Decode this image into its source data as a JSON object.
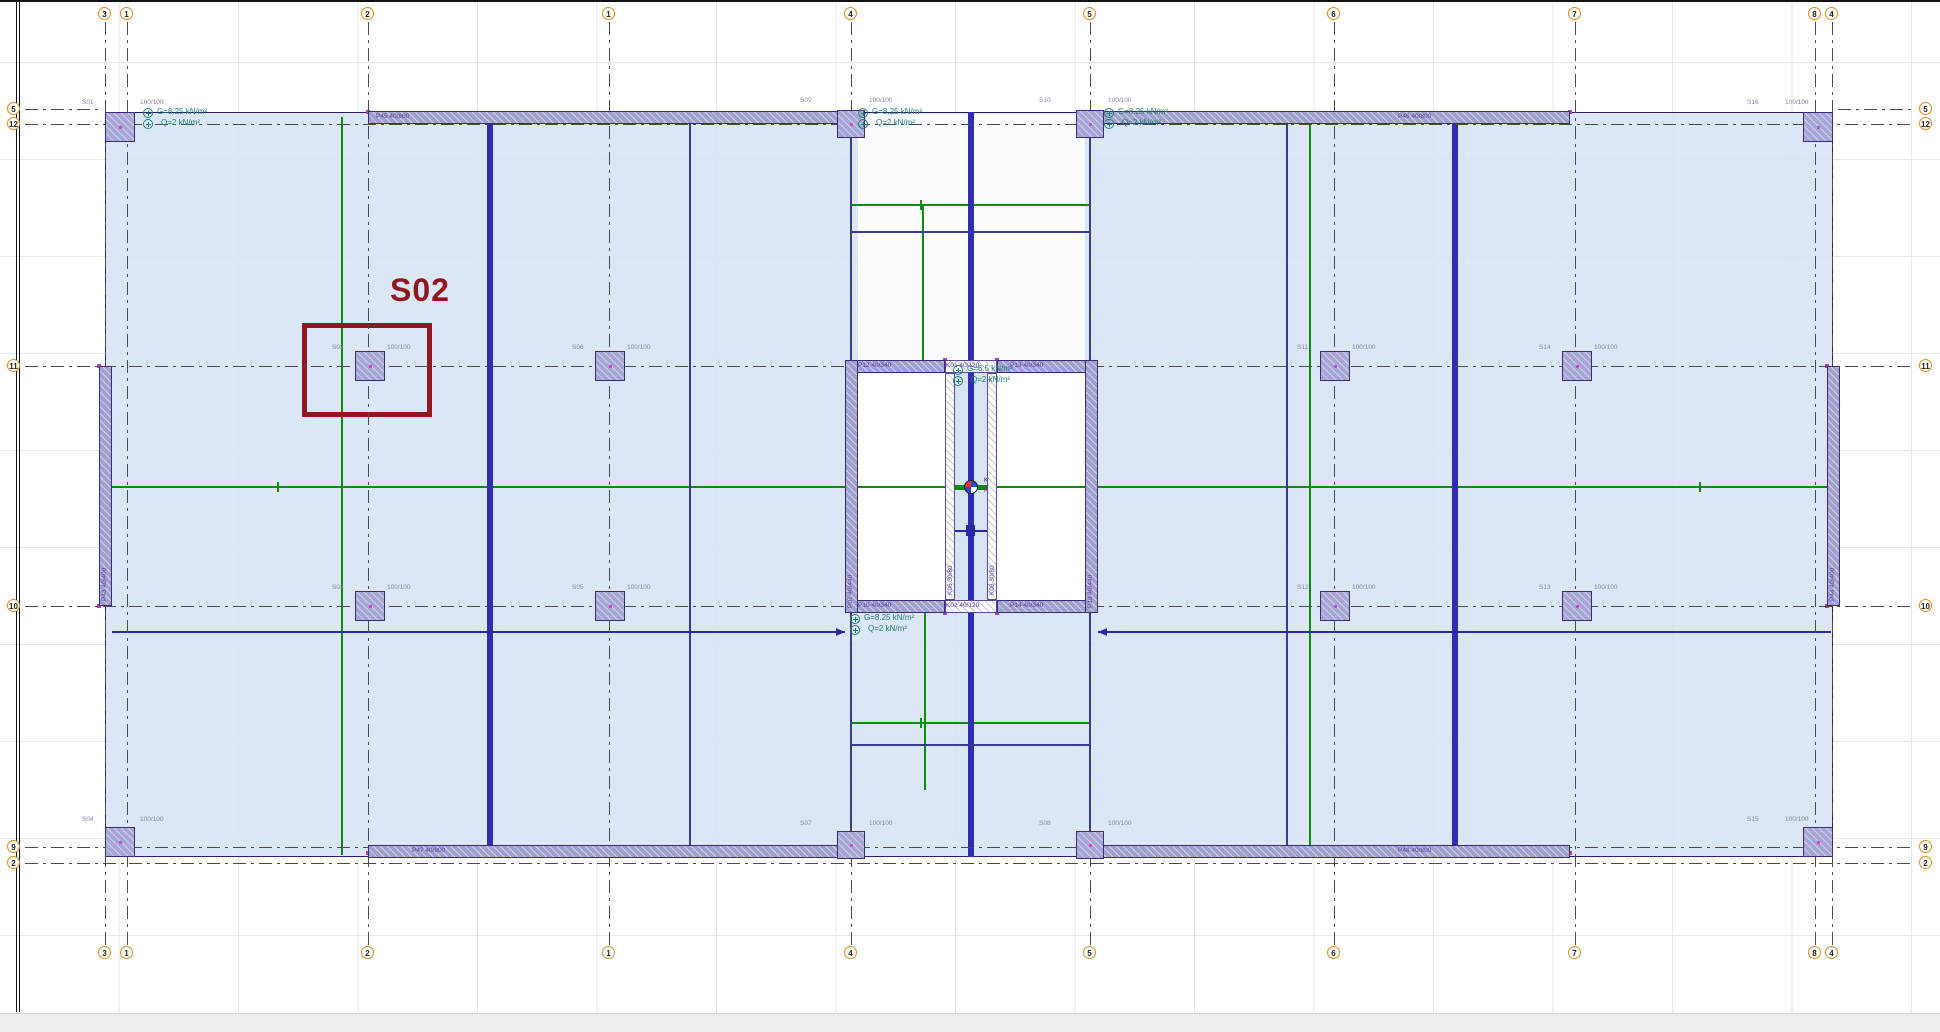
{
  "highlight": {
    "label": "S02"
  },
  "axes": {
    "vertical": [
      {
        "label": "3",
        "x": 105
      },
      {
        "label": "1",
        "x": 127
      },
      {
        "label": "2",
        "x": 368
      },
      {
        "label": "1",
        "x": 609
      },
      {
        "label": "4",
        "x": 851
      },
      {
        "label": "5",
        "x": 1090
      },
      {
        "label": "6",
        "x": 1334
      },
      {
        "label": "7",
        "x": 1575
      },
      {
        "label": "8",
        "x": 1815
      },
      {
        "label": "4",
        "x": 1832
      }
    ],
    "horizontal": [
      {
        "label": "5",
        "y": 109,
        "full": false
      },
      {
        "label": "12",
        "y": 124,
        "full": true
      },
      {
        "label": "11",
        "y": 366,
        "full": true
      },
      {
        "label": "10",
        "y": 606,
        "full": true
      },
      {
        "label": "9",
        "y": 847,
        "full": true
      },
      {
        "label": "2",
        "y": 863,
        "full": true
      }
    ]
  },
  "columns": [
    {
      "name": "S01",
      "size": "100/100",
      "x": 105,
      "y": 112,
      "w": 30,
      "h": 30,
      "nx": 82,
      "ny": 99,
      "sx": 140
    },
    {
      "name": "S09",
      "size": "100/100",
      "x": 837,
      "y": 110,
      "w": 28,
      "h": 28,
      "nx": 800,
      "ny": 97,
      "sx": 869
    },
    {
      "name": "S10",
      "size": "100/100",
      "x": 1076,
      "y": 110,
      "w": 28,
      "h": 28,
      "nx": 1039,
      "ny": 97,
      "sx": 1108
    },
    {
      "name": "S16",
      "size": "100/100",
      "x": 1803,
      "y": 112,
      "w": 30,
      "h": 30,
      "nx": 1747,
      "ny": 99,
      "sx": 1785
    },
    {
      "name": "S02",
      "size": "100/100",
      "x": 355,
      "y": 351,
      "w": 30,
      "h": 30,
      "nx": 332,
      "ny": 344,
      "sx": 387
    },
    {
      "name": "S06",
      "size": "100/100",
      "x": 595,
      "y": 351,
      "w": 30,
      "h": 30,
      "nx": 572,
      "ny": 344,
      "sx": 627
    },
    {
      "name": "S11",
      "size": "100/100",
      "x": 1320,
      "y": 351,
      "w": 30,
      "h": 30,
      "nx": 1297,
      "ny": 344,
      "sx": 1352
    },
    {
      "name": "S14",
      "size": "100/100",
      "x": 1562,
      "y": 351,
      "w": 30,
      "h": 30,
      "nx": 1539,
      "ny": 344,
      "sx": 1594
    },
    {
      "name": "S03",
      "size": "100/100",
      "x": 355,
      "y": 591,
      "w": 30,
      "h": 30,
      "nx": 332,
      "ny": 584,
      "sx": 387
    },
    {
      "name": "S05",
      "size": "100/100",
      "x": 595,
      "y": 591,
      "w": 30,
      "h": 30,
      "nx": 572,
      "ny": 584,
      "sx": 627
    },
    {
      "name": "S12",
      "size": "100/100",
      "x": 1320,
      "y": 591,
      "w": 30,
      "h": 30,
      "nx": 1297,
      "ny": 584,
      "sx": 1352
    },
    {
      "name": "S13",
      "size": "100/100",
      "x": 1562,
      "y": 591,
      "w": 30,
      "h": 30,
      "nx": 1539,
      "ny": 584,
      "sx": 1594
    },
    {
      "name": "S04",
      "size": "100/100",
      "x": 105,
      "y": 827,
      "w": 30,
      "h": 30,
      "nx": 82,
      "ny": 816,
      "sx": 140
    },
    {
      "name": "S07",
      "size": "100/100",
      "x": 837,
      "y": 831,
      "w": 28,
      "h": 28,
      "nx": 800,
      "ny": 820,
      "sx": 869
    },
    {
      "name": "S08",
      "size": "100/100",
      "x": 1076,
      "y": 831,
      "w": 28,
      "h": 28,
      "nx": 1039,
      "ny": 820,
      "sx": 1108
    },
    {
      "name": "S15",
      "size": "100/100",
      "x": 1803,
      "y": 827,
      "w": 30,
      "h": 30,
      "nx": 1747,
      "ny": 816,
      "sx": 1785
    }
  ],
  "walls": [
    {
      "label": "P45 40/800",
      "x": 368,
      "y": 111,
      "w": 483,
      "h": 13,
      "kind": "wall",
      "lx": 376,
      "ly": 113
    },
    {
      "label": "P46 40/800",
      "x": 1090,
      "y": 111,
      "w": 480,
      "h": 13,
      "kind": "wall",
      "lx": 1398,
      "ly": 113
    },
    {
      "label": "P47 40/800",
      "x": 368,
      "y": 845,
      "w": 483,
      "h": 13,
      "kind": "wall",
      "lx": 412,
      "ly": 847
    },
    {
      "label": "P48 40/800",
      "x": 1090,
      "y": 845,
      "w": 480,
      "h": 13,
      "kind": "wall",
      "lx": 1398,
      "ly": 847
    },
    {
      "label": "P43 40/400",
      "x": 99,
      "y": 366,
      "w": 13,
      "h": 240,
      "kind": "wall",
      "vert": true
    },
    {
      "label": "P44 40/400",
      "x": 1827,
      "y": 366,
      "w": 13,
      "h": 240,
      "kind": "wall",
      "vert": true
    },
    {
      "label": "P12 40/340",
      "x": 845,
      "y": 360,
      "w": 100,
      "h": 13,
      "kind": "wall",
      "lx": 858,
      "ly": 362
    },
    {
      "label": "K01 40/120",
      "x": 945,
      "y": 360,
      "w": 52,
      "h": 13,
      "kind": "beam",
      "lx": 946,
      "ly": 362
    },
    {
      "label": "P13 40/340",
      "x": 997,
      "y": 360,
      "w": 101,
      "h": 13,
      "kind": "wall",
      "lx": 1010,
      "ly": 362
    },
    {
      "label": "P10 40/340",
      "x": 845,
      "y": 600,
      "w": 100,
      "h": 13,
      "kind": "wall",
      "lx": 858,
      "ly": 602
    },
    {
      "label": "K02 40/120",
      "x": 945,
      "y": 600,
      "w": 52,
      "h": 13,
      "kind": "beam",
      "lx": 946,
      "ly": 602
    },
    {
      "label": "P14 40/340",
      "x": 997,
      "y": 600,
      "w": 101,
      "h": 13,
      "kind": "wall",
      "lx": 1010,
      "ly": 602
    },
    {
      "label": "P07 40/440",
      "x": 845,
      "y": 360,
      "w": 13,
      "h": 253,
      "kind": "wall",
      "vert": true
    },
    {
      "label": "P18 40/440",
      "x": 1085,
      "y": 360,
      "w": 13,
      "h": 253,
      "kind": "wall",
      "vert": true
    },
    {
      "label": "K06 30/80",
      "x": 945,
      "y": 373,
      "w": 10,
      "h": 227,
      "kind": "beam",
      "vert": true
    },
    {
      "label": "K08 30/80",
      "x": 987,
      "y": 373,
      "w": 10,
      "h": 227,
      "kind": "beam",
      "vert": true
    }
  ],
  "loads": [
    {
      "g": "G=8.25 kN/m²",
      "q": "Q=2 kN/m²",
      "x": 143,
      "y": 107
    },
    {
      "g": "G=8.25 kN/m²",
      "q": "Q=2 kN/m²",
      "x": 858,
      "y": 107
    },
    {
      "g": "G=8.25 kN/m²",
      "q": "Q=2 kN/m²",
      "x": 1104,
      "y": 107
    },
    {
      "g": "G=6.5 kN/m²",
      "q": "Q=2 kN/m²",
      "x": 953,
      "y": 364
    },
    {
      "g": "G=8.25 kN/m²",
      "q": "Q=2 kN/m²",
      "x": 850,
      "y": 613
    }
  ],
  "marker": {
    "km": "KM",
    "kr": "KR"
  },
  "colors": {
    "slab_fill": "#d8e4f3",
    "wall_fill": "#a0a0cf",
    "column_fill": "#a6a6d6",
    "beam_blue": "#2e2eae",
    "axis_green": "#0f8c0f",
    "load_teal": "#1e7e74",
    "highlight_maroon": "#8e1722",
    "bubble_orange": "#e08a1e"
  }
}
